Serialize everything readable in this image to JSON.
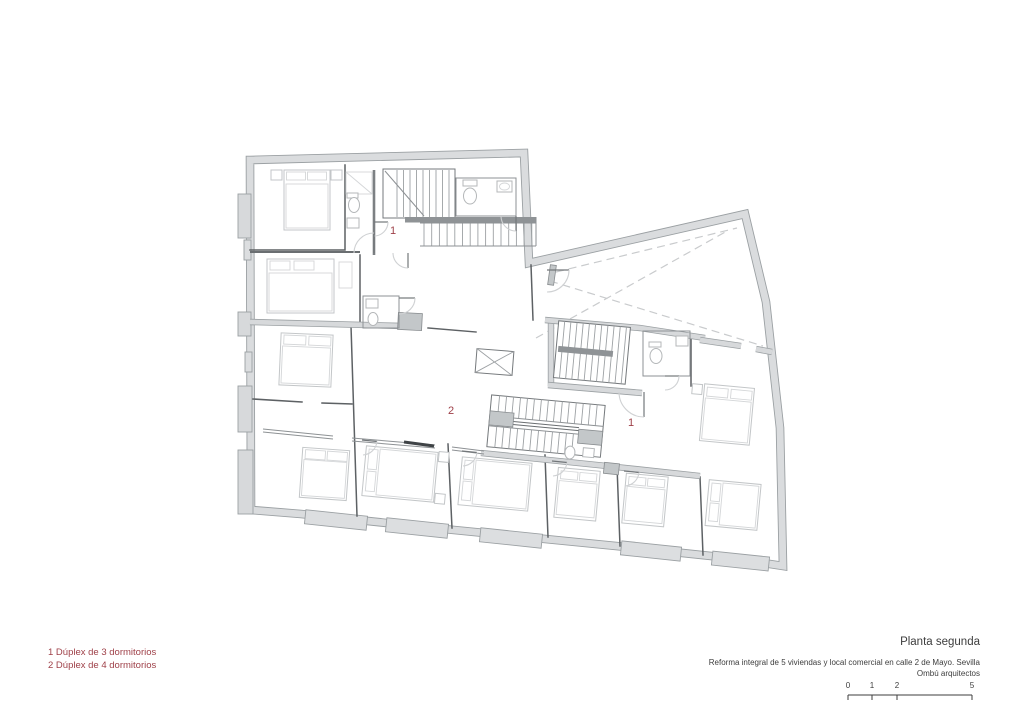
{
  "plan": {
    "unit_labels": [
      "1",
      "2",
      "1"
    ]
  },
  "legend": {
    "items": [
      "1 Dúplex de 3 dormitorios",
      "2 Dúplex de 4 dormitorios"
    ]
  },
  "title_block": {
    "title": "Planta segunda",
    "subtitle": "Reforma integral de 5 viviendas y local comercial en calle 2 de Mayo. Sevilla",
    "firm": "Ombú arquitectos"
  },
  "scale_bar": {
    "labels": [
      "0",
      "1",
      "2",
      "5"
    ]
  },
  "colors": {
    "accent_red": "#9e3f47",
    "wall_fill": "#dadcde",
    "wall_edge": "#9ba0a3"
  }
}
